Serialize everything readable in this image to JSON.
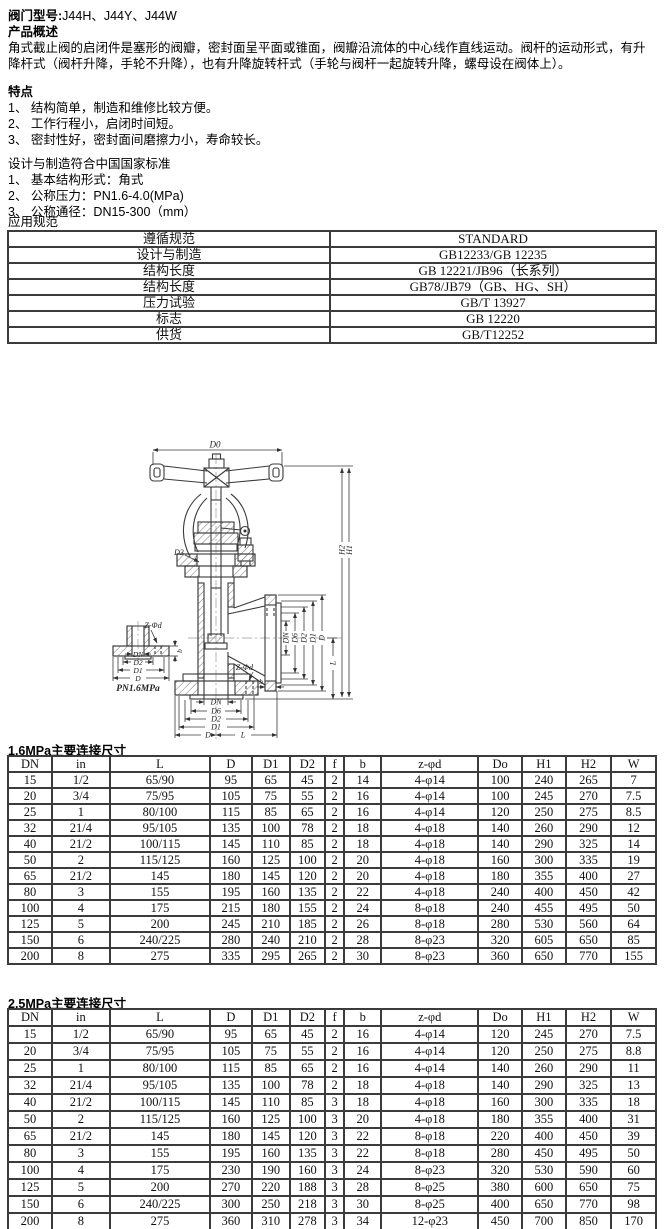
{
  "page": {
    "model_label": "阀门型号:",
    "model_value": "J44H、J44Y、J44W",
    "overview_title": "产品概述",
    "overview_text": "角式截止阀的启闭件是塞形的阀瓣，密封面呈平面或锥面，阀瓣沿流体的中心线作直线运动。阀杆的运动形式，有升降杆式（阀杆升降，手轮不升降），也有升降旋转杆式（手轮与阀杆一起旋转升降，螺母设在阀体上）。",
    "features_title": "特点",
    "features": [
      "1、 结构简单，制造和维修比较方便。",
      "2、 工作行程小，启闭时间短。",
      "3、 密封性好，密封面间磨擦力小，寿命较长。"
    ],
    "design_title": "设计与制造符合中国国家标准",
    "design_items": [
      "1、 基本结构形式：角式",
      "2、 公称压力：PN1.6-4.0(MPa)",
      "3、 公称通径：DN15-300（mm）"
    ],
    "application_title": "应用规范"
  },
  "standards_table": {
    "rows": [
      [
        "遵循规范",
        "STANDARD"
      ],
      [
        "设计与制造",
        "GB12233/GB 12235"
      ],
      [
        "结构长度",
        "GB 12221/JB96（长系列）"
      ],
      [
        "结构长度",
        "GB78/JB79（GB、HG、SH）"
      ],
      [
        "压力试验",
        "GB/T 13927"
      ],
      [
        "标志",
        "GB 12220"
      ],
      [
        "供货",
        "GB/T12252"
      ]
    ]
  },
  "drawing": {
    "labels": {
      "d0": "D0",
      "d3": "D3",
      "dn": "DN",
      "d6": "D6",
      "d2": "D2",
      "d1": "D1",
      "d": "D",
      "l": "L",
      "b": "b",
      "h1": "H1",
      "h2": "H2",
      "z_phi_d": "Z-Φd",
      "pn": "PN1.6MPa"
    }
  },
  "table_16": {
    "title": "1.6MPa主要连接尺寸",
    "headers": [
      "DN",
      "in",
      "L",
      "D",
      "D1",
      "D2",
      "f",
      "b",
      "z-φd",
      "Do",
      "H1",
      "H2",
      "W"
    ],
    "rows": [
      [
        "15",
        "1/2",
        "65/90",
        "95",
        "65",
        "45",
        "2",
        "14",
        "4-φ14",
        "100",
        "240",
        "265",
        "7"
      ],
      [
        "20",
        "3/4",
        "75/95",
        "105",
        "75",
        "55",
        "2",
        "16",
        "4-φ14",
        "100",
        "245",
        "270",
        "7.5"
      ],
      [
        "25",
        "1",
        "80/100",
        "115",
        "85",
        "65",
        "2",
        "16",
        "4-φ14",
        "120",
        "250",
        "275",
        "8.5"
      ],
      [
        "32",
        "21/4",
        "95/105",
        "135",
        "100",
        "78",
        "2",
        "18",
        "4-φ18",
        "140",
        "260",
        "290",
        "12"
      ],
      [
        "40",
        "21/2",
        "100/115",
        "145",
        "110",
        "85",
        "2",
        "18",
        "4-φ18",
        "140",
        "290",
        "325",
        "14"
      ],
      [
        "50",
        "2",
        "115/125",
        "160",
        "125",
        "100",
        "2",
        "20",
        "4-φ18",
        "160",
        "300",
        "335",
        "19"
      ],
      [
        "65",
        "21/2",
        "145",
        "180",
        "145",
        "120",
        "2",
        "20",
        "4-φ18",
        "180",
        "355",
        "400",
        "27"
      ],
      [
        "80",
        "3",
        "155",
        "195",
        "160",
        "135",
        "2",
        "22",
        "4-φ18",
        "240",
        "400",
        "450",
        "42"
      ],
      [
        "100",
        "4",
        "175",
        "215",
        "180",
        "155",
        "2",
        "24",
        "8-φ18",
        "240",
        "455",
        "495",
        "50"
      ],
      [
        "125",
        "5",
        "200",
        "245",
        "210",
        "185",
        "2",
        "26",
        "8-φ18",
        "280",
        "530",
        "560",
        "64"
      ],
      [
        "150",
        "6",
        "240/225",
        "280",
        "240",
        "210",
        "2",
        "28",
        "8-φ23",
        "320",
        "605",
        "650",
        "85"
      ],
      [
        "200",
        "8",
        "275",
        "335",
        "295",
        "265",
        "2",
        "30",
        "8-φ23",
        "360",
        "650",
        "770",
        "155"
      ]
    ]
  },
  "table_25": {
    "title": "2.5MPa主要连接尺寸",
    "headers": [
      "DN",
      "in",
      "L",
      "D",
      "D1",
      "D2",
      "f",
      "b",
      "z-φd",
      "Do",
      "H1",
      "H2",
      "W"
    ],
    "rows": [
      [
        "15",
        "1/2",
        "65/90",
        "95",
        "65",
        "45",
        "2",
        "16",
        "4-φ14",
        "120",
        "245",
        "270",
        "7.5"
      ],
      [
        "20",
        "3/4",
        "75/95",
        "105",
        "75",
        "55",
        "2",
        "16",
        "4-φ14",
        "120",
        "250",
        "275",
        "8.8"
      ],
      [
        "25",
        "1",
        "80/100",
        "115",
        "85",
        "65",
        "2",
        "16",
        "4-φ14",
        "140",
        "260",
        "290",
        "11"
      ],
      [
        "32",
        "21/4",
        "95/105",
        "135",
        "100",
        "78",
        "2",
        "18",
        "4-φ18",
        "140",
        "290",
        "325",
        "13"
      ],
      [
        "40",
        "21/2",
        "100/115",
        "145",
        "110",
        "85",
        "3",
        "18",
        "4-φ18",
        "160",
        "300",
        "335",
        "18"
      ],
      [
        "50",
        "2",
        "115/125",
        "160",
        "125",
        "100",
        "3",
        "20",
        "4-φ18",
        "180",
        "355",
        "400",
        "31"
      ],
      [
        "65",
        "21/2",
        "145",
        "180",
        "145",
        "120",
        "3",
        "22",
        "8-φ18",
        "220",
        "400",
        "450",
        "39"
      ],
      [
        "80",
        "3",
        "155",
        "195",
        "160",
        "135",
        "3",
        "22",
        "8-φ18",
        "280",
        "450",
        "495",
        "50"
      ],
      [
        "100",
        "4",
        "175",
        "230",
        "190",
        "160",
        "3",
        "24",
        "8-φ23",
        "320",
        "530",
        "590",
        "60"
      ],
      [
        "125",
        "5",
        "200",
        "270",
        "220",
        "188",
        "3",
        "28",
        "8-φ25",
        "380",
        "600",
        "650",
        "75"
      ],
      [
        "150",
        "6",
        "240/225",
        "300",
        "250",
        "218",
        "3",
        "30",
        "8-φ25",
        "400",
        "650",
        "770",
        "98"
      ],
      [
        "200",
        "8",
        "275",
        "360",
        "310",
        "278",
        "3",
        "34",
        "12-φ23",
        "450",
        "700",
        "850",
        "170"
      ]
    ]
  }
}
